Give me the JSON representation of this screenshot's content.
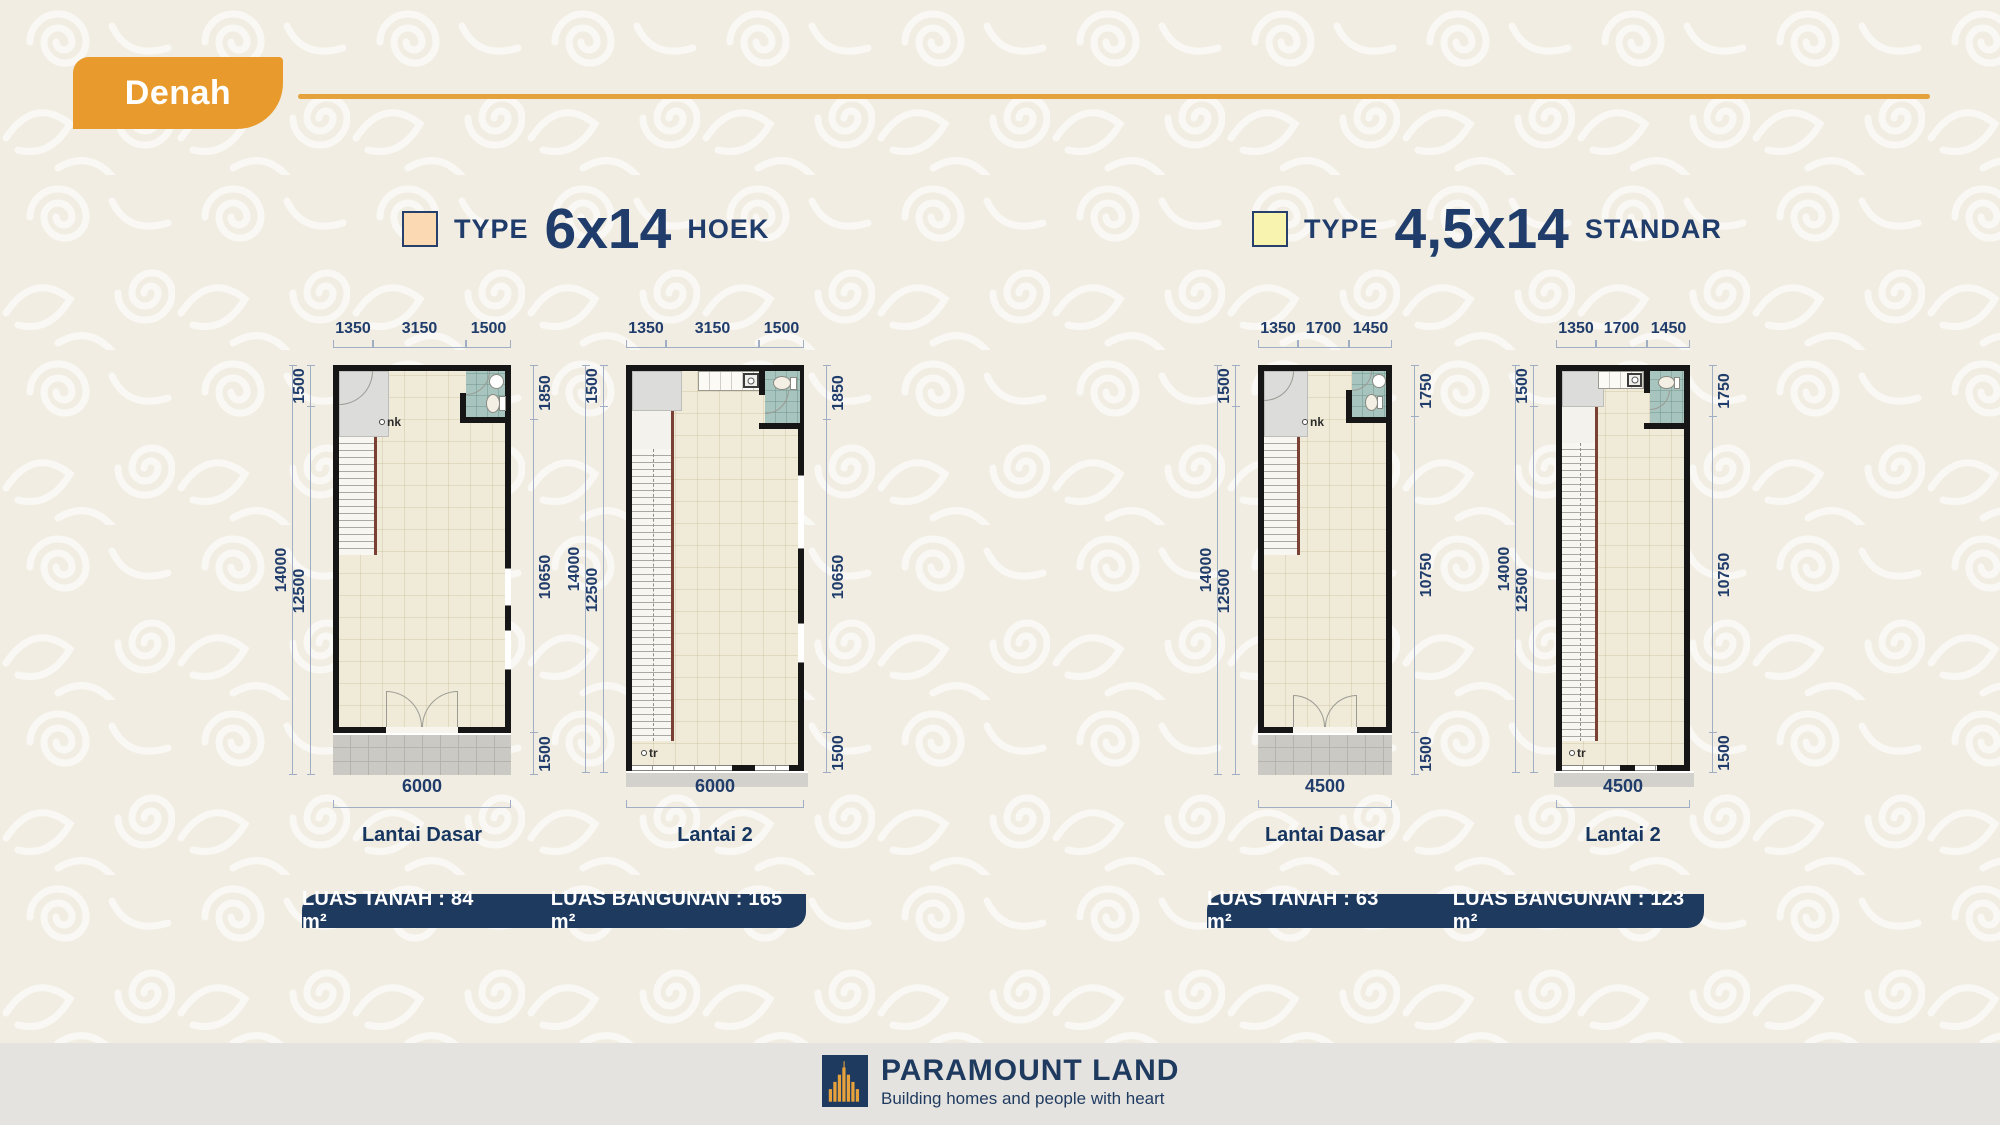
{
  "header": {
    "badge_label": "Denah"
  },
  "colors": {
    "accent_orange": "#E89B2C",
    "divider_gold": "#E5A13B",
    "navy_text": "#1F3C6B",
    "banner_navy": "#1E3A5F",
    "swatch_hoek": "#FBD9B3",
    "swatch_standar": "#F8F3AE",
    "floor_cream": "#F0EBD8",
    "bathroom_teal": "#A7C4BE",
    "background_cream": "#F1EDE2"
  },
  "type_headers": [
    {
      "prefix": "TYPE",
      "size": "6x14",
      "suffix": "HOEK"
    },
    {
      "prefix": "TYPE",
      "size": "4,5x14",
      "suffix": "STANDAR"
    }
  ],
  "plans": [
    {
      "floor_label": "Lantai Dasar",
      "top_dims": [
        "1350",
        "3150",
        "1500"
      ],
      "left_total": "14000",
      "left_top": "1500",
      "left_main": "12500",
      "right_top": "1850",
      "right_main": "10650",
      "right_bottom": "1500",
      "bottom_width": "6000",
      "stair_label": "nk"
    },
    {
      "floor_label": "Lantai 2",
      "top_dims": [
        "1350",
        "3150",
        "1500"
      ],
      "left_total": "14000",
      "left_top": "1500",
      "left_main": "12500",
      "right_top": "1850",
      "right_main": "10650",
      "right_bottom": "1500",
      "bottom_width": "6000",
      "stair_label": "tr"
    },
    {
      "floor_label": "Lantai Dasar",
      "top_dims": [
        "1350",
        "1700",
        "1450"
      ],
      "left_total": "14000",
      "left_top": "1500",
      "left_main": "12500",
      "right_top": "1750",
      "right_main": "10750",
      "right_bottom": "1500",
      "bottom_width": "4500",
      "stair_label": "nk"
    },
    {
      "floor_label": "Lantai 2",
      "top_dims": [
        "1350",
        "1700",
        "1450"
      ],
      "left_total": "14000",
      "left_top": "1500",
      "left_main": "12500",
      "right_top": "1750",
      "right_main": "10750",
      "right_bottom": "1500",
      "bottom_width": "4500",
      "stair_label": "tr"
    }
  ],
  "banners": [
    {
      "tanah": "LUAS TANAH : 84 m²",
      "bangunan": "LUAS BANGUNAN : 165 m²"
    },
    {
      "tanah": "LUAS TANAH : 63 m²",
      "bangunan": "LUAS BANGUNAN : 123 m²"
    }
  ],
  "footer": {
    "brand": "PARAMOUNT LAND",
    "tagline": "Building homes and people with heart"
  }
}
